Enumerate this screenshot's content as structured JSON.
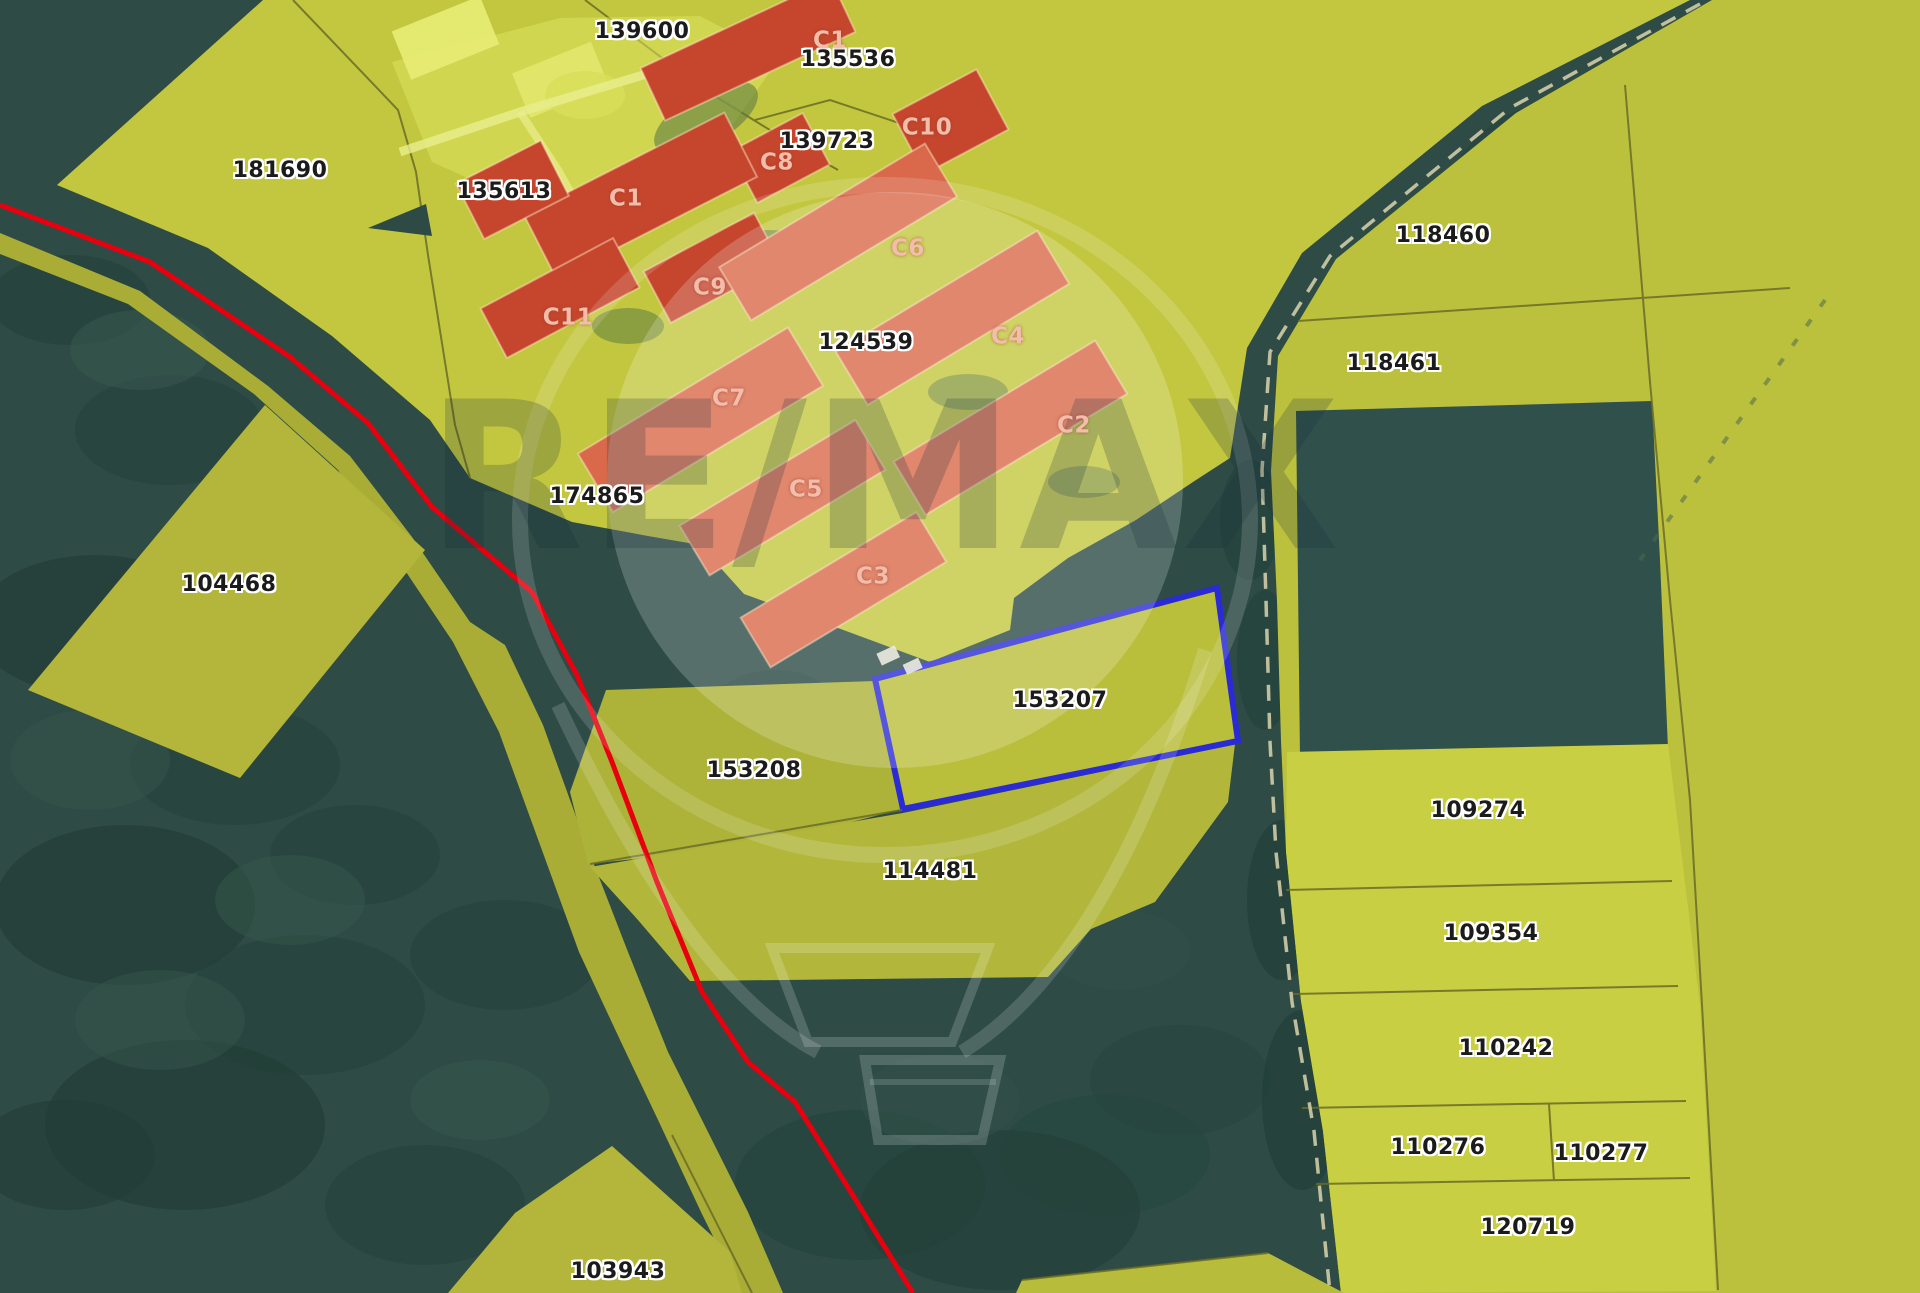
{
  "map": {
    "type": "cadastral-aerial-map",
    "watermark": {
      "text": "RE/MAX"
    },
    "highlighted_parcel": {
      "id": "153207",
      "outline_color": "#2b2bd5"
    },
    "red_boundary_line_color": "#e8000f",
    "colors": {
      "forest": "#2e4b45",
      "forest_dark": "#23403a",
      "forest_light": "#3c5c51",
      "parcel_yellow": "#bcc13d",
      "parcel_olive": "#adb239",
      "parcel_bright": "#c9cf42",
      "farm_yellow": "#c3c73f",
      "farm_light": "#dce25f",
      "building_red": "#c5462d",
      "building_salmon": "#e4825f",
      "blue_fill": "#b9be3b",
      "boundary_line": "#6a6c26",
      "road_path": "#d9d3ae",
      "label_text": "#1b1b1b",
      "building_label_text": "#f3bdab"
    },
    "parcel_labels": [
      {
        "id": "139600",
        "text": "139600",
        "x": 642,
        "y": 32
      },
      {
        "id": "135536",
        "text": "135536",
        "x": 848,
        "y": 60
      },
      {
        "id": "139723",
        "text": "139723",
        "x": 827,
        "y": 142
      },
      {
        "id": "181690",
        "text": "181690",
        "x": 280,
        "y": 171
      },
      {
        "id": "135613",
        "text": "135613",
        "x": 504,
        "y": 192
      },
      {
        "id": "124539",
        "text": "124539",
        "x": 866,
        "y": 343
      },
      {
        "id": "118460",
        "text": "118460",
        "x": 1443,
        "y": 236
      },
      {
        "id": "118461",
        "text": "118461",
        "x": 1394,
        "y": 364
      },
      {
        "id": "174865",
        "text": "174865",
        "x": 597,
        "y": 497
      },
      {
        "id": "104468",
        "text": "104468",
        "x": 229,
        "y": 585
      },
      {
        "id": "153207",
        "text": "153207",
        "x": 1060,
        "y": 701
      },
      {
        "id": "153208",
        "text": "153208",
        "x": 754,
        "y": 771
      },
      {
        "id": "109274",
        "text": "109274",
        "x": 1478,
        "y": 811
      },
      {
        "id": "114481",
        "text": "114481",
        "x": 930,
        "y": 872
      },
      {
        "id": "109354",
        "text": "109354",
        "x": 1491,
        "y": 934
      },
      {
        "id": "110242",
        "text": "110242",
        "x": 1506,
        "y": 1049
      },
      {
        "id": "110276",
        "text": "110276",
        "x": 1438,
        "y": 1148
      },
      {
        "id": "110277",
        "text": "110277",
        "x": 1601,
        "y": 1154
      },
      {
        "id": "120719",
        "text": "120719",
        "x": 1528,
        "y": 1228
      },
      {
        "id": "103943",
        "text": "103943",
        "x": 618,
        "y": 1272
      }
    ],
    "building_labels": [
      {
        "id": "c1-top",
        "text": "C1",
        "x": 830,
        "y": 41
      },
      {
        "id": "c10",
        "text": "C10",
        "x": 927,
        "y": 128
      },
      {
        "id": "c8",
        "text": "C8",
        "x": 777,
        "y": 163
      },
      {
        "id": "c1-main",
        "text": "C1",
        "x": 626,
        "y": 199
      },
      {
        "id": "c6",
        "text": "C6",
        "x": 908,
        "y": 249
      },
      {
        "id": "c9",
        "text": "C9",
        "x": 710,
        "y": 288
      },
      {
        "id": "c11",
        "text": "C11",
        "x": 568,
        "y": 318
      },
      {
        "id": "c4",
        "text": "C4",
        "x": 1008,
        "y": 337
      },
      {
        "id": "c7",
        "text": "C7",
        "x": 729,
        "y": 399
      },
      {
        "id": "c2",
        "text": "C2",
        "x": 1074,
        "y": 426
      },
      {
        "id": "c5",
        "text": "C5",
        "x": 806,
        "y": 490
      },
      {
        "id": "c3",
        "text": "C3",
        "x": 873,
        "y": 577
      }
    ]
  }
}
